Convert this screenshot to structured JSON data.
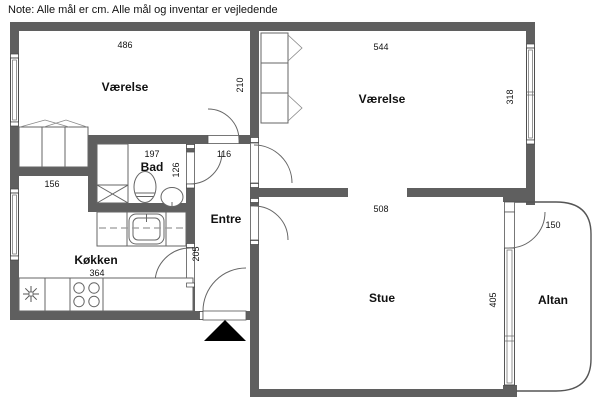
{
  "note": "Note: Alle mål er cm. Alle mål og inventar er vejledende",
  "rooms": {
    "vaerelse_left": {
      "name": "Værelse",
      "width": "486"
    },
    "vaerelse_right": {
      "name": "Værelse",
      "width": "544",
      "depth": "318",
      "divider_wall": "210"
    },
    "bad": {
      "name": "Bad",
      "width": "197",
      "depth": "126"
    },
    "koekken": {
      "name": "Køkken",
      "width": "364",
      "nook_width": "156",
      "door_wall": "205"
    },
    "entre": {
      "name": "Entre",
      "width": "116"
    },
    "stue": {
      "name": "Stue",
      "width": "508",
      "depth": "405"
    },
    "altan": {
      "name": "Altan",
      "width": "150"
    }
  },
  "colors": {
    "wall": "#5f5f5f",
    "line": "#555555",
    "text": "#111111",
    "entrance_marker": "#000000"
  }
}
